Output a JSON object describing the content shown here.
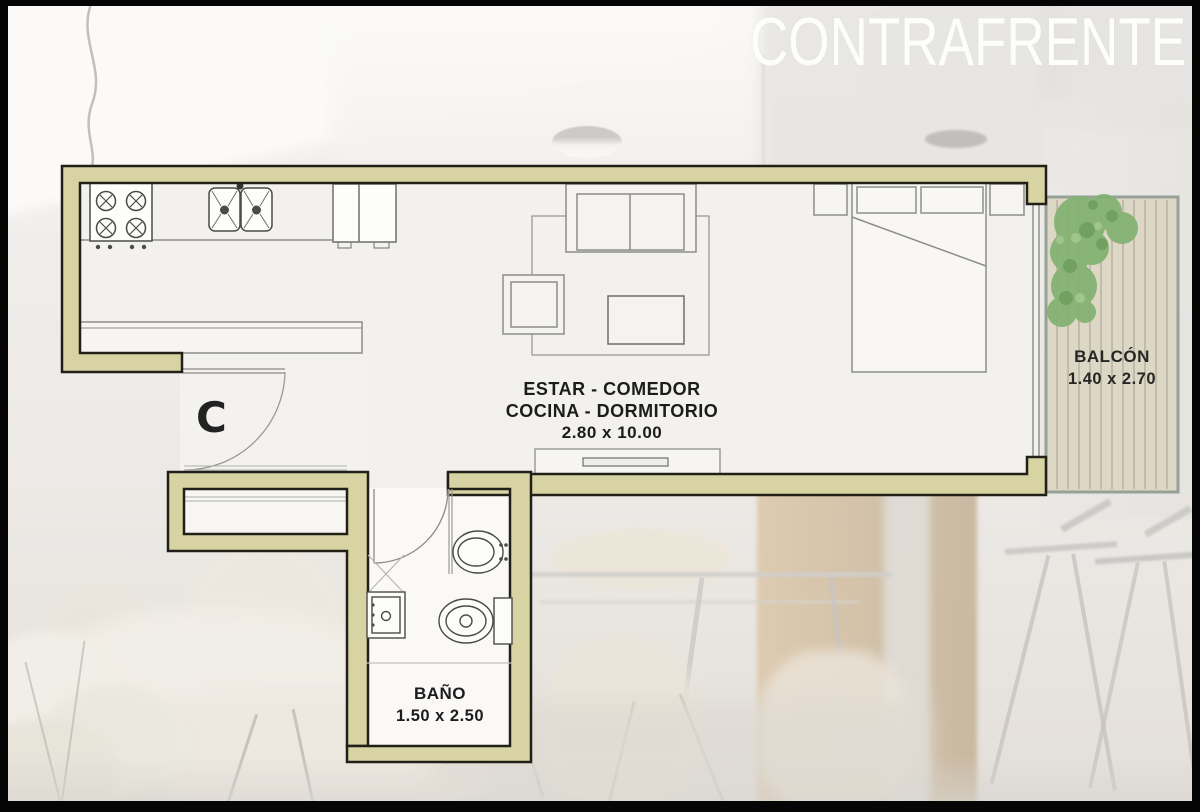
{
  "title": "CONTRAFRENTE",
  "plan": {
    "unit_letter": "C",
    "main_room": {
      "name_line1": "ESTAR - COMEDOR",
      "name_line2": "COCINA - DORMITORIO",
      "dimensions": "2.80 x 10.00"
    },
    "balcony": {
      "name": "BALCÓN",
      "dimensions": "1.40 x 2.70"
    },
    "bathroom": {
      "name": "BAÑO",
      "dimensions": "1.50 x 2.50"
    }
  },
  "colors": {
    "wall_fill": "#d8d3a2",
    "wall_outline": "#202018",
    "floor": "#f2f1ee",
    "bathroom_floor": "#faf9f7",
    "deck": "#ddd7c6",
    "deck_border": "#96a197",
    "deck_plank_line": "#b9b1a1",
    "plant_green": "#82b271",
    "furniture_line": "#8d8d8b",
    "fixture_line": "#4a4a48",
    "label_text": "#1c1c1c",
    "title_text": "#fdfdfc"
  },
  "icons": {
    "stove": "stove-icon",
    "kitchen_sink": "kitchen-sink-icon",
    "fridge": "fridge-icon",
    "sofa": "sofa-icon",
    "armchair": "armchair-icon",
    "coffee_table": "coffee-table-icon",
    "rug": "rug-outline",
    "tv_unit": "tv-unit-icon",
    "bed": "bed-icon",
    "nightstand": "nightstand-icon",
    "toilet": "toilet-icon",
    "bidet": "bidet-icon",
    "bath_sink": "bath-sink-icon",
    "door_swing": "door-swing-arc",
    "balcony_plant": "plant-icon",
    "ceiling_lamp": "ceiling-lamp-icon"
  }
}
